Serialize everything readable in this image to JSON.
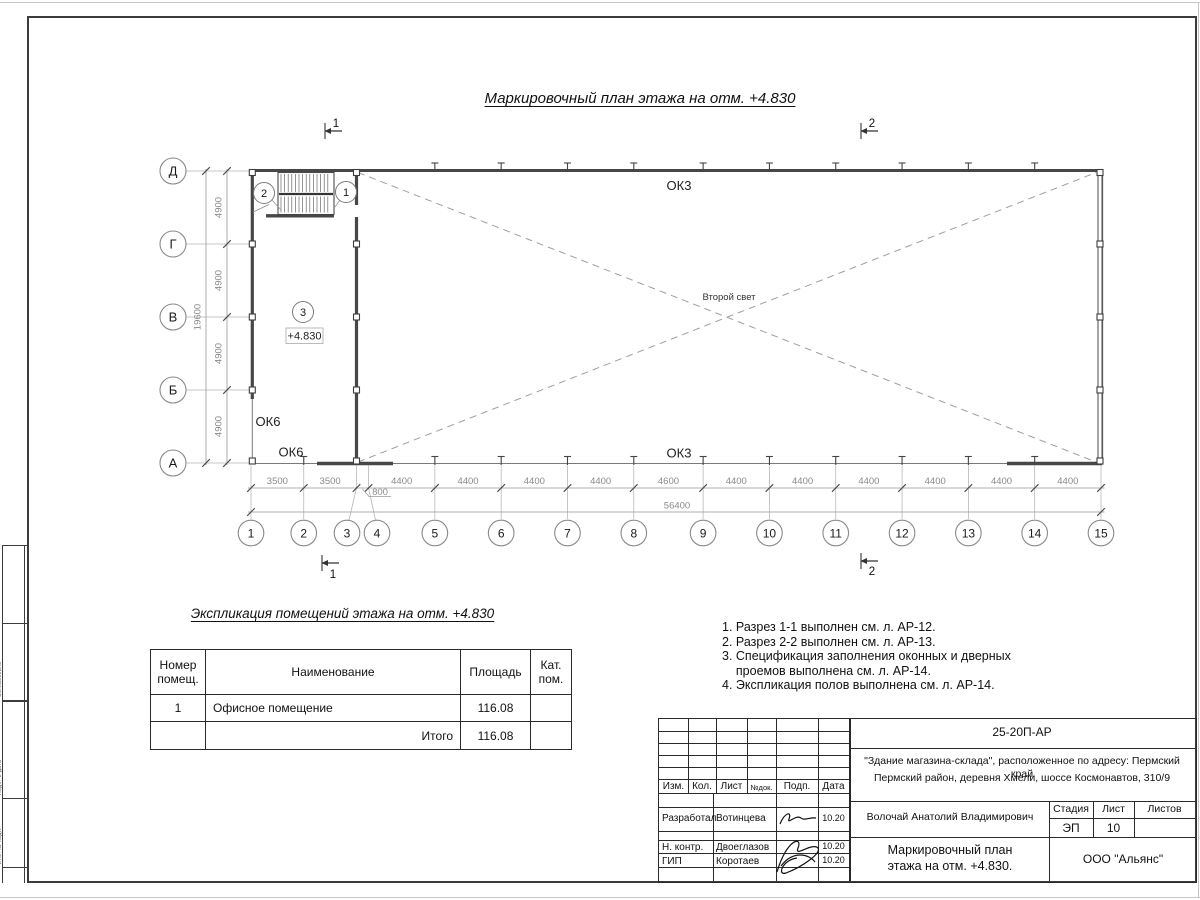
{
  "sheet": {
    "main_title": "Маркировочный план этажа на отм. +4.830",
    "side_labels": [
      "Согласовано",
      "Подп. и дата",
      "Инв. № подл."
    ]
  },
  "plan": {
    "row_axes": [
      "Д",
      "Г",
      "В",
      "Б",
      "А"
    ],
    "row_spacing_label": "4900",
    "row_total_label": "19600",
    "col_axes": [
      "1",
      "2",
      "3",
      "4",
      "5",
      "6",
      "7",
      "8",
      "9",
      "10",
      "11",
      "12",
      "13",
      "14",
      "15"
    ],
    "col_dims": [
      "3500",
      "3500",
      "800",
      "4400",
      "4400",
      "4400",
      "4400",
      "4600",
      "4400",
      "4400",
      "4400",
      "4400",
      "4400",
      "4400"
    ],
    "col_total": "56400",
    "labels": {
      "ok3_top": "ОК3",
      "ok3_bottom": "ОК3",
      "ok6_left": "ОК6",
      "ok6_bottom": "ОК6",
      "second_light": "Второй свет",
      "level_mark": "+4.830",
      "room_tag": "3",
      "stair_tag_left": "2",
      "stair_tag_right": "1"
    },
    "section_markers": {
      "top_left": "1",
      "top_right": "2",
      "bottom_left": "1",
      "bottom_right": "2"
    }
  },
  "explication": {
    "title": "Экспликация помещений этажа на отм. +4.830",
    "headers": [
      "Номер\nпомещ.",
      "Наименование",
      "Площадь",
      "Кат.\nпом."
    ],
    "row1": {
      "num": "1",
      "name": "Офисное помещение",
      "area": "116.08",
      "cat": ""
    },
    "total_label": "Итого",
    "total_value": "116.08"
  },
  "notes": [
    "1. Разрез 1-1 выполнен см. л. АР-12.",
    "2. Разрез 2-2 выполнен см. л. АР-13.",
    "3. Спецификация заполнения оконных и дверных",
    "    проемов выполнена см. л. АР-14.",
    "4. Экспликация полов выполнена см. л. АР-14."
  ],
  "title_block": {
    "doc_code": "25-20П-АР",
    "address_line1": "\"Здание магазина-склада\", расположенное по адресу: Пермский край",
    "address_line2": "Пермский район, деревня Хмели, шоссе Космонавтов, 310/9",
    "header_cells": [
      "Изм.",
      "Кол.",
      "Лист",
      "№док.",
      "Подп.",
      "Дата"
    ],
    "rows": [
      {
        "role": "Разработал",
        "name": "Вотинцева",
        "date": "10.20"
      },
      {
        "role": "Н. контр.",
        "name": "Двоеглазов",
        "date": "10.20"
      },
      {
        "role": "ГИП",
        "name": "Коротаев",
        "date": "10.20"
      }
    ],
    "chief": "Волочай Анатолий Владимирович",
    "stage_label": "Стадия",
    "sheet_label": "Лист",
    "sheets_label": "Листов",
    "stage_value": "ЭП",
    "sheet_value": "10",
    "drawing_title_line1": "Маркировочный план",
    "drawing_title_line2": "этажа на отм. +4.830.",
    "company": "ООО \"Альянс\""
  }
}
